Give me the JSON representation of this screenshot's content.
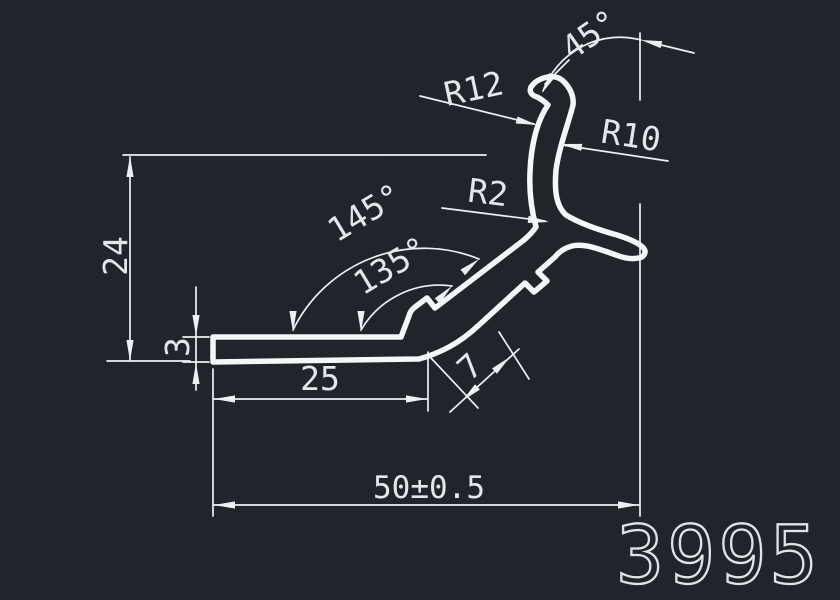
{
  "drawing": {
    "background_color": "#20252c",
    "line_color": "#edf0f2",
    "profile_color": "#f4f6f7",
    "part_number": "3995",
    "dimensions": {
      "top_angle": "45°",
      "hook_outer_radius": "R12",
      "hook_inner_radius": "R10",
      "junction_fillet_radius": "R2",
      "upper_web_angle": "145°",
      "lower_web_angle": "135°",
      "overall_height": "24",
      "base_thickness": "3",
      "base_flat_length": "25",
      "web_width": "7",
      "overall_width": "50±0.5"
    }
  }
}
